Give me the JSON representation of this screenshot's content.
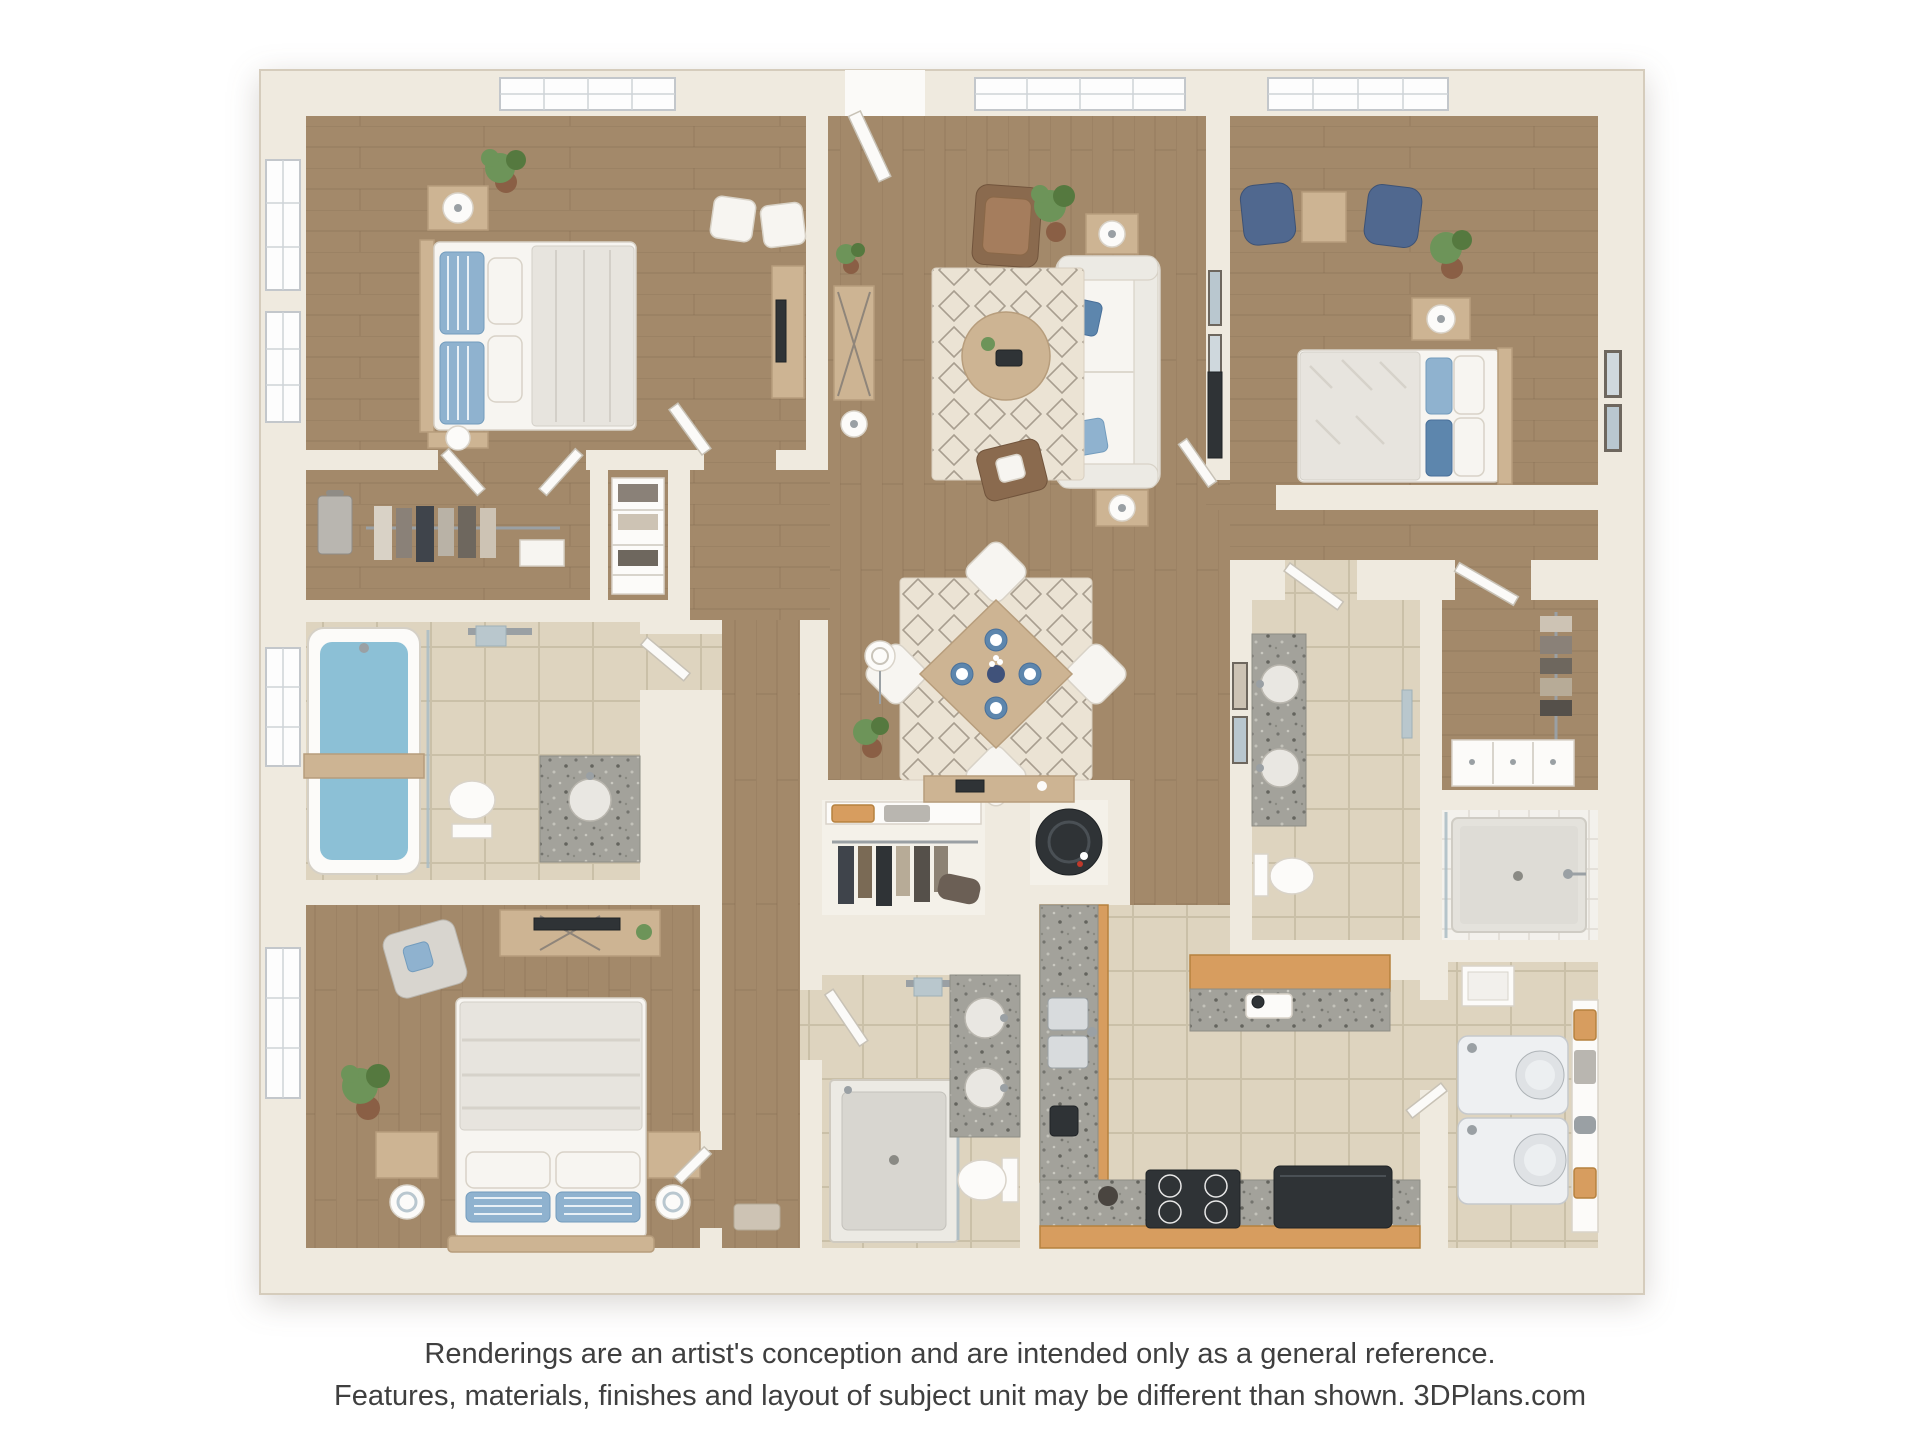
{
  "disclaimer": {
    "line1": "Renderings are an artist's conception and are intended only as a general reference.",
    "line2": "Features, materials, finishes and layout of subject unit may be different than shown. 3DPlans.com"
  },
  "palette": {
    "wall": "#efeadf",
    "wallEdge": "#d5ccbc",
    "wood": "#a3896a",
    "woodLine": "#826a4f",
    "tile": "#ded4bf",
    "grout": "#c6bba3",
    "tileWhite": "#f3f1ec",
    "groutWhite": "#ddd8d0",
    "granite": "#a3a29b",
    "cabinet": "#d79d5f",
    "furnWood": "#cdb493",
    "rug": "#ebe3d4",
    "rugLine": "#8c8172",
    "fabric": "#f7f5f1",
    "fabricEdge": "#d8d2c7",
    "duvet": "#e7e4de",
    "leather": "#8a6a4e",
    "blueChair": "#50688f",
    "pillowBlue": "#8fb2cf",
    "pillowBlueDeep": "#5d86ad",
    "water": "#8cc0d6",
    "plant": "#6d9459",
    "plantDark": "#55793f",
    "appliance": "#2f3336",
    "applianceWhite": "#eef0f2",
    "glass": "#a9bcc4",
    "metal": "#9aa0a4",
    "frame": "#6e675e",
    "closetFloor": "#f4f1e9",
    "text": "#3f3f3f"
  },
  "rooms": [
    "bedroom-top-left",
    "living-room",
    "bedroom-top-right",
    "walk-in-closet-top",
    "hallway",
    "bathroom-top-left",
    "dining-area",
    "master-bedroom",
    "coat-closet",
    "water-heater-closet",
    "master-bathroom",
    "kitchen",
    "laundry-room",
    "bathroom-right",
    "walk-in-closet-right",
    "walk-in-shower-room"
  ]
}
